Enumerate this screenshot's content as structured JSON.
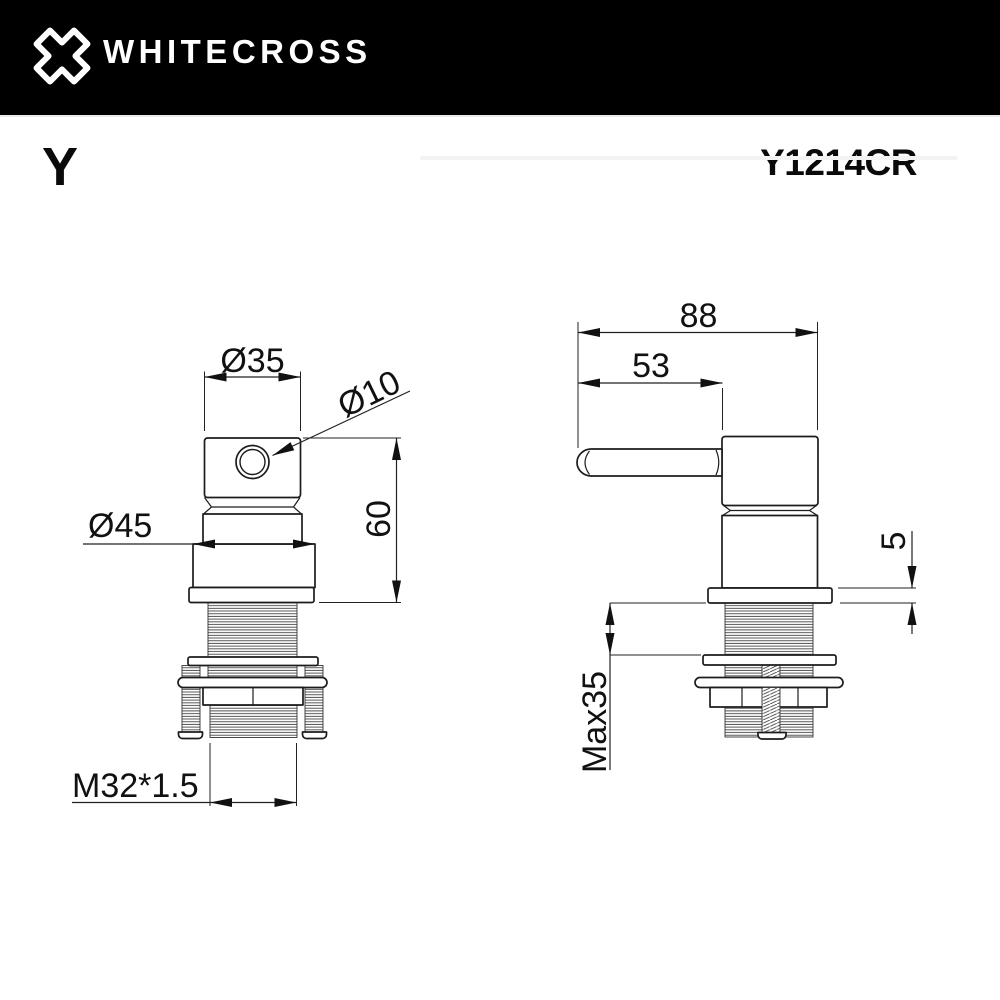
{
  "header": {
    "logo_icon": "whitecross-x-mark",
    "brand": "WHITECROSS"
  },
  "product": {
    "series": "Y",
    "code": "Y1214CR"
  },
  "front_view": {
    "dim_top_diameter": "Ø35",
    "dim_hole_diameter": "Ø10",
    "dim_collar_diameter": "Ø45",
    "dim_height": "60",
    "dim_thread": "M32*1.5"
  },
  "side_view": {
    "dim_total_length": "88",
    "dim_handle_length": "53",
    "dim_flange_thickness": "5",
    "dim_max_mounting": "Max35"
  },
  "colors": {
    "header_bg": "#000000",
    "line": "#1c1c1c",
    "text": "#111111"
  }
}
